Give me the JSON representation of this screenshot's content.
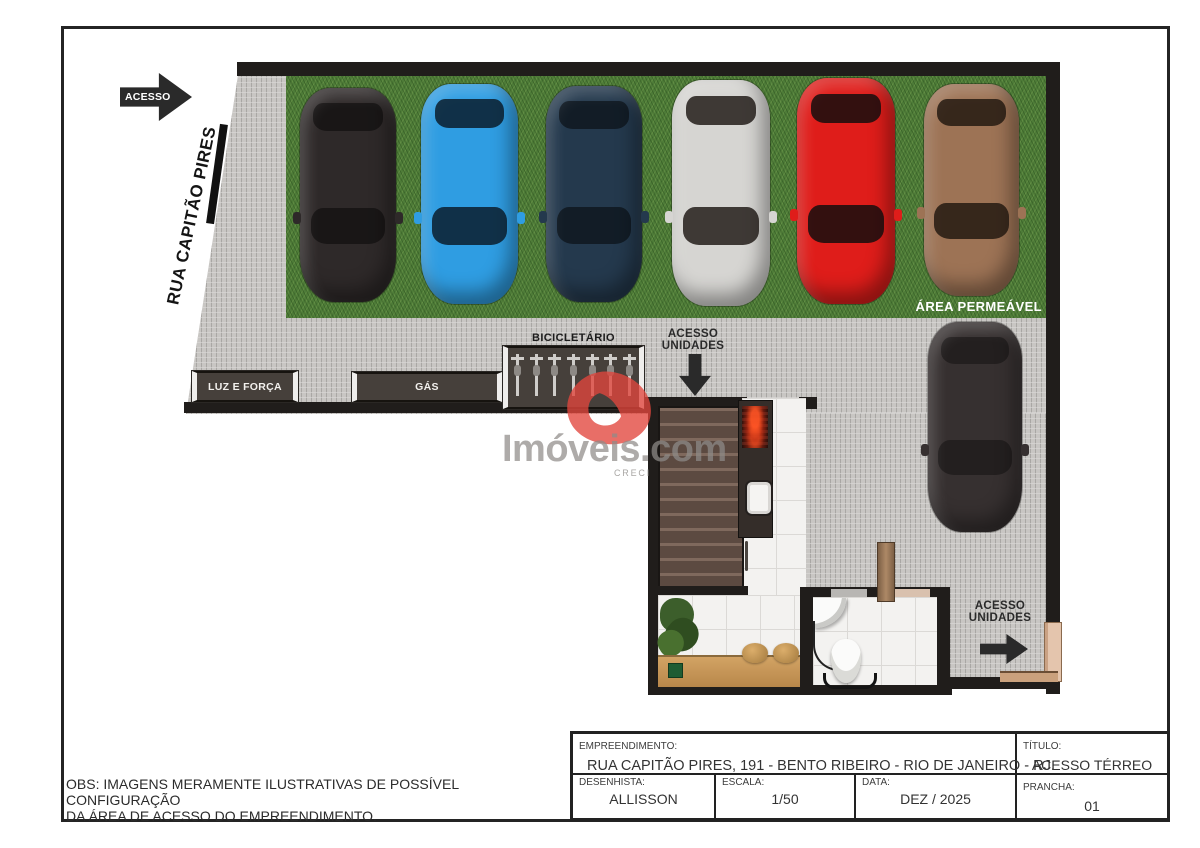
{
  "sheet": {
    "obs": {
      "line1": "OBS: IMAGENS MERAMENTE ILUSTRATIVAS DE POSSÍVEL CONFIGURAÇÃO",
      "line2": "DA ÁREA DE ACESSO DO EMPREENDIMENTO."
    }
  },
  "plan": {
    "street": {
      "access_arrow_label": "ACESSO",
      "street_name": "RUA CAPITÃO PIRES"
    },
    "labels": {
      "permeable_area": "ÁREA PERMEÁVEL",
      "bike_rack": "BICICLETÁRIO",
      "power": "LUZ E FORÇA",
      "gas": "GÁS",
      "units_access_line1": "ACESSO",
      "units_access_line2": "UNIDADES"
    },
    "parked_cars": [
      {
        "name": "black-car",
        "body": "#2e2929",
        "glass": "rgba(0,0,0,0.45)"
      },
      {
        "name": "blue-car",
        "body": "#2f9de2",
        "glass": "rgba(8,18,28,0.78)"
      },
      {
        "name": "navy-car",
        "body": "#24394d",
        "glass": "rgba(0,0,0,0.5)"
      },
      {
        "name": "silver-car",
        "body": "#d6d5d2",
        "glass": "rgba(28,22,18,0.82)"
      },
      {
        "name": "red-car",
        "body": "#df1d1a",
        "glass": "rgba(14,14,14,0.82)"
      },
      {
        "name": "brown-car",
        "body": "#9d7355",
        "glass": "rgba(26,18,12,0.78)"
      }
    ],
    "driveway_car": {
      "name": "black-car",
      "body": "#363030",
      "glass": "rgba(0,0,0,0.35)"
    },
    "colors": {
      "grass": "#4e7c38",
      "paving": "#c8c6c3",
      "wall": "#201d1b",
      "cabinet": "#46403b",
      "stairs": "#6b564c",
      "wood": "#c9995c"
    }
  },
  "watermark": {
    "brand": "Imóveis.com",
    "subtext": "CRECI",
    "logo_color": "#e2463d"
  },
  "title_block": {
    "project_label": "EMPREENDIMENTO:",
    "project": "RUA CAPITÃO PIRES, 191 - BENTO RIBEIRO - RIO DE JANEIRO - RJ.",
    "drafter_label": "DESENHISTA:",
    "drafter": "ALLISSON",
    "scale_label": "ESCALA:",
    "scale": "1/50",
    "date_label": "DATA:",
    "date": "DEZ / 2025",
    "title_label": "TÍTULO:",
    "title": "ACESSO TÉRREO",
    "sheet_label": "PRANCHA:",
    "sheet_number": "01"
  }
}
